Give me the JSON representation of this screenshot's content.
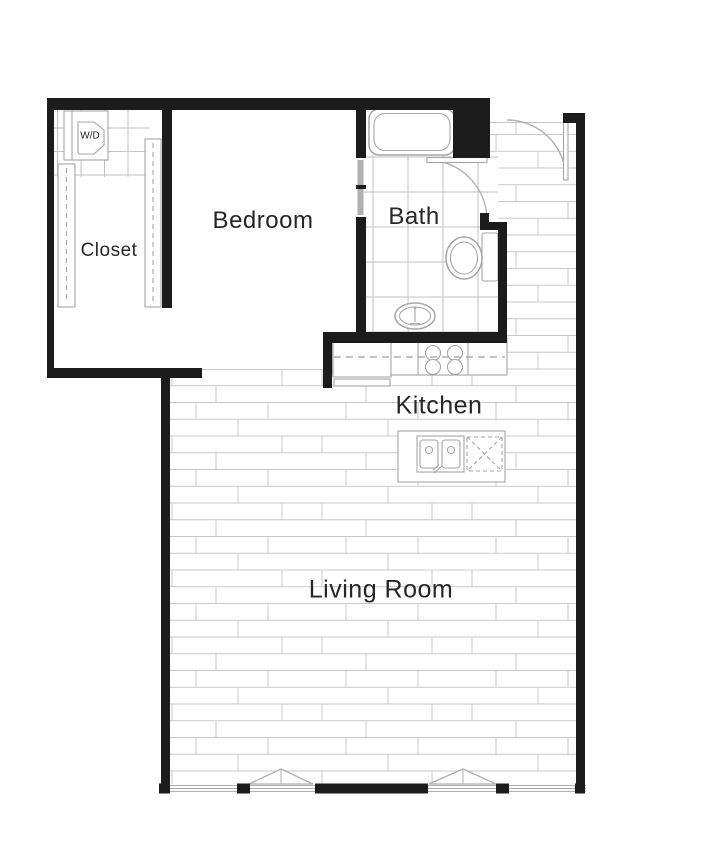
{
  "canvas": {
    "width": 708,
    "height": 844
  },
  "rooms": {
    "bedroom": {
      "label": "Bedroom"
    },
    "closet": {
      "label": "Closet"
    },
    "bath": {
      "label": "Bath"
    },
    "kitchen": {
      "label": "Kitchen"
    },
    "living_room": {
      "label": "Living Room"
    },
    "washer_dryer": {
      "label": "W/D"
    }
  },
  "fixtures": [
    "bathtub",
    "toilet",
    "pedestal-sink",
    "bath-door",
    "entry-door",
    "pocket-door",
    "refrigerator",
    "stove",
    "kitchen-counter",
    "upper-cabinets-dashed",
    "kitchen-island",
    "kitchen-sink",
    "dishwasher",
    "closet-rod-left",
    "closet-rod-right",
    "washer-dryer-unit",
    "window-band",
    "casement-window-left",
    "casement-window-right",
    "wood-floor",
    "tile-floor"
  ],
  "colors": {
    "background": "#ffffff",
    "wall": "#1c1c1c",
    "floor_line": "#c9c9c9",
    "tile_line": "#c2c2c2",
    "fixture_outline": "#a6a6a6",
    "door_arc": "#b3b3b3",
    "dash_line": "#9e9e9e",
    "window_line": "#b0b0b0",
    "text": "#262626"
  }
}
